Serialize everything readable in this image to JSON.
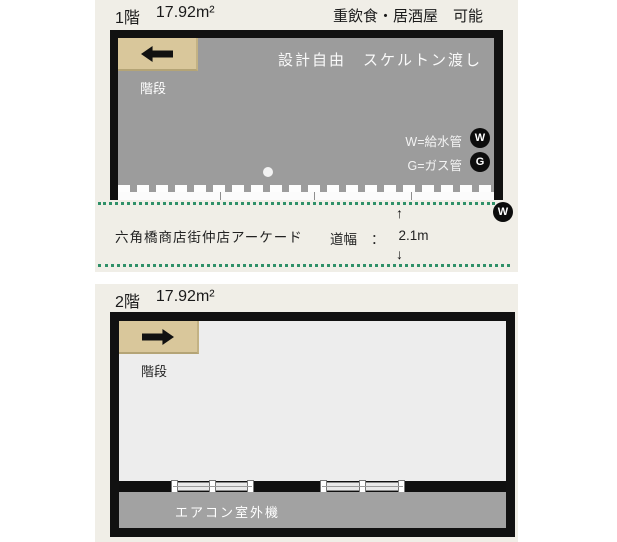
{
  "floor1": {
    "floor_label": "1階",
    "area": "17.92m²",
    "usage_note": "重飲食・居酒屋　可能",
    "stairs_label": "階段",
    "interior_note": "設計自由　スケルトン渡し",
    "water_legend": "W=給水管",
    "gas_legend": "G=ガス管",
    "water_badge": "W",
    "gas_badge": "G",
    "street_water_badge": "W",
    "street_name": "六角橋商店街仲店アーケード",
    "road_width_label": "道幅",
    "road_width_separator": "：",
    "road_width_value": "2.1m",
    "arrow_up": "↑",
    "arrow_down": "↓"
  },
  "floor2": {
    "floor_label": "2階",
    "area": "17.92m²",
    "stairs_label": "階段",
    "balcony_label": "エアコン室外機"
  },
  "colors": {
    "panel_bg": "#f0eee7",
    "room1_fill": "#9c9c9c",
    "room2_fill": "#ededed",
    "balcony_fill": "#a2a2a2",
    "stairs_fill": "#d9c79b",
    "wall": "#111111",
    "arcade_dots_green": "#2f9068",
    "badge_bg": "#0c0c0c"
  }
}
